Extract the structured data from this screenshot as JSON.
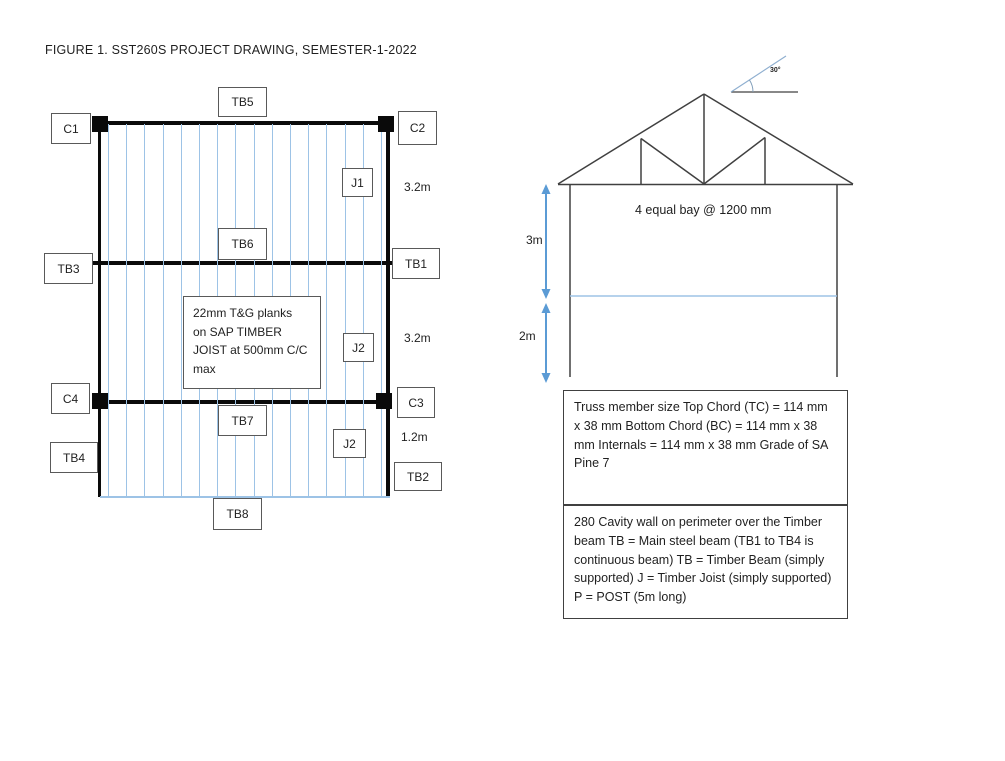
{
  "title": "FIGURE 1. SST260S PROJECT DRAWING, SEMESTER-1-2022",
  "plan": {
    "beams": {
      "tb1": "TB1",
      "tb2": "TB2",
      "tb3": "TB3",
      "tb4": "TB4",
      "tb5": "TB5",
      "tb6": "TB6",
      "tb7": "TB7",
      "tb8": "TB8"
    },
    "columns": {
      "c1": "C1",
      "c2": "C2",
      "c3": "C3",
      "c4": "C4"
    },
    "joists": {
      "j1": "J1",
      "j2_mid": "J2",
      "j2_bottom": "J2"
    },
    "dims": {
      "bay_top": "3.2m",
      "bay_mid": "3.2m",
      "bay_bottom": "1.2m"
    },
    "note": "22mm T&G planks\non SAP TIMBER\nJOIST at 500mm C/C\nmax",
    "joist_line_count": 16
  },
  "elevation": {
    "bay_note": "4 equal bay @ 1200 mm",
    "angle_label": "30°",
    "dims": {
      "upper": "3m",
      "lower": "2m"
    }
  },
  "notes": {
    "truss_members": "Truss member size Top Chord (TC) = 114 mm x 38 mm Bottom Chord (BC) = 114 mm x 38 mm Internals = 114 mm x 38 mm Grade of SA Pine 7",
    "legend": "280 Cavity wall on perimeter over the Timber beam TB = Main steel beam (TB1 to TB4 is continuous beam) TB = Timber Beam (simply supported) J = Timber Joist (simply supported) P = POST (5m long)"
  },
  "colors": {
    "beam": "#0a0a0a",
    "line": "#404040",
    "joist": "#9dc3e6",
    "dimension": "#5b9bd5",
    "text": "#1f1f1f",
    "box_border": "#595959"
  }
}
